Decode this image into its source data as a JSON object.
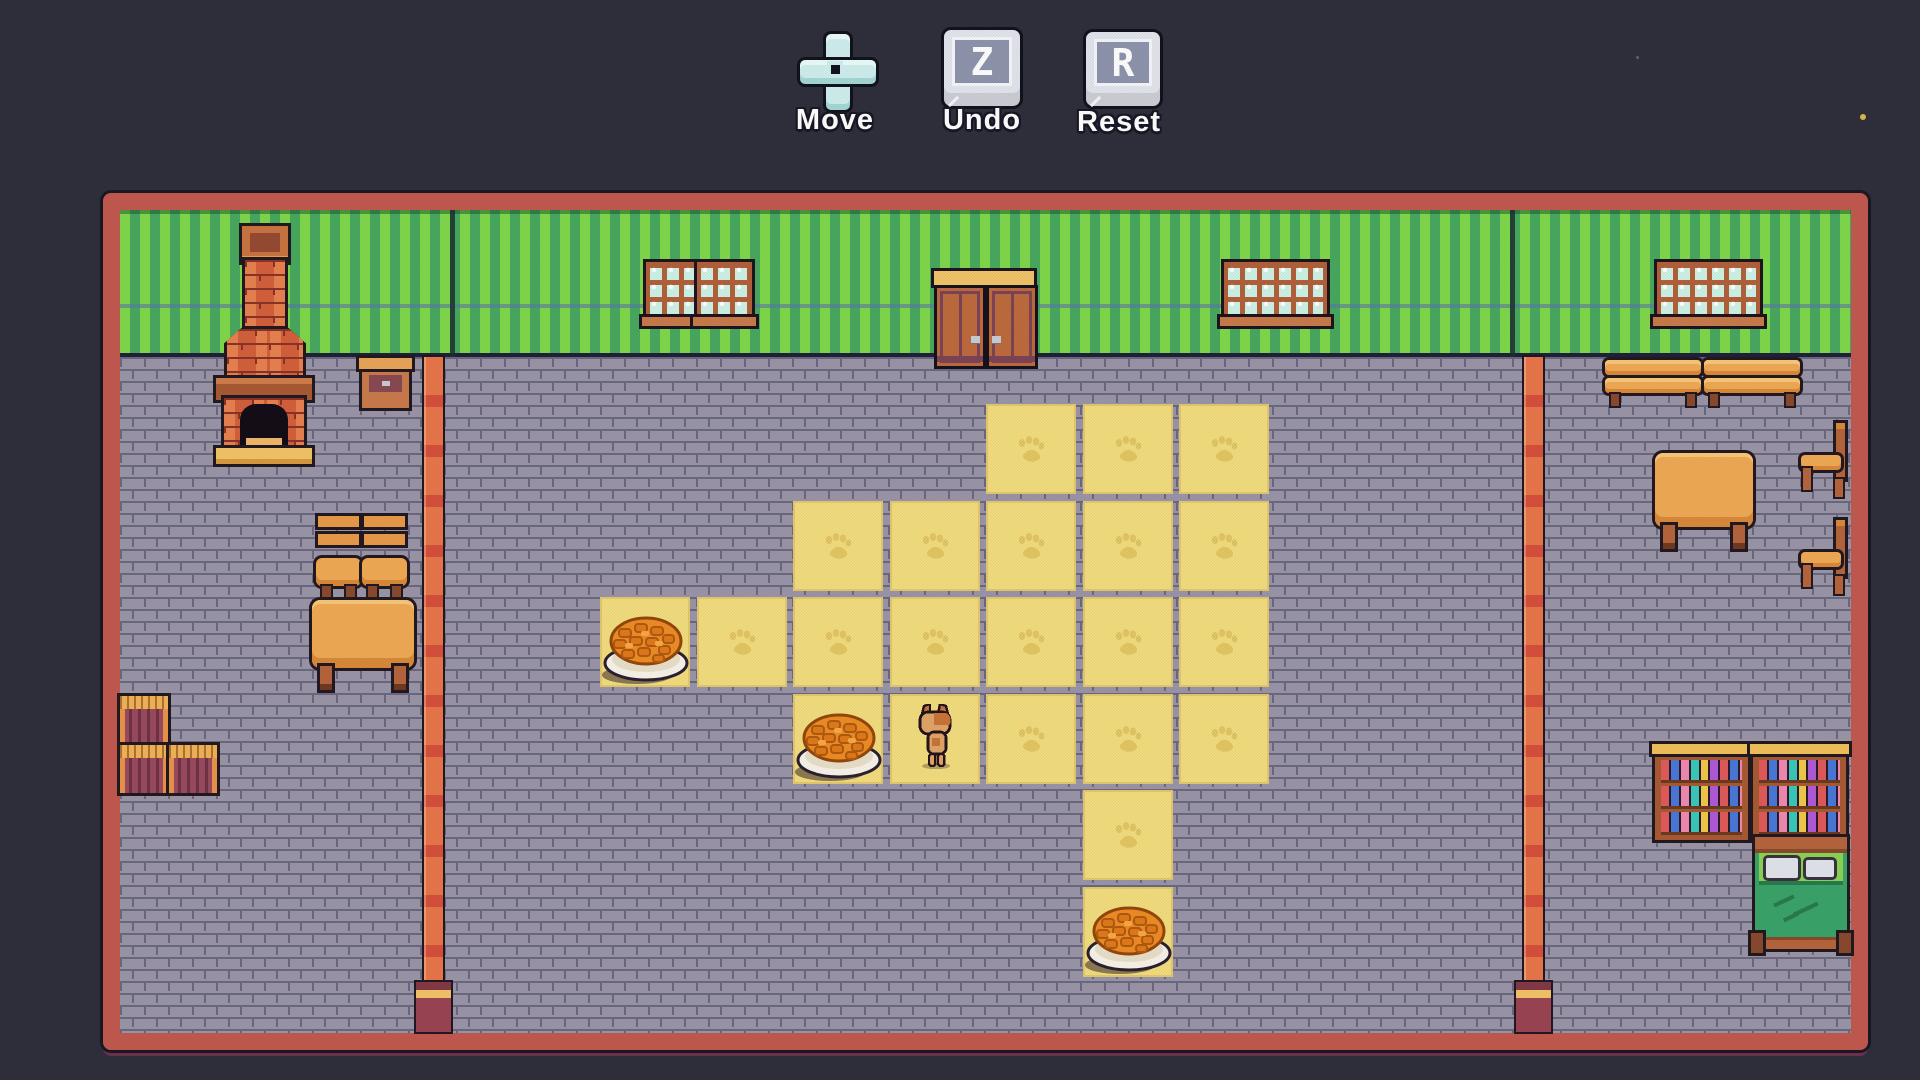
{
  "ui": {
    "controls": [
      {
        "id": "move",
        "label": "Move",
        "type": "dpad"
      },
      {
        "id": "undo",
        "label": "Undo",
        "type": "key",
        "key": "Z"
      },
      {
        "id": "reset",
        "label": "Reset",
        "type": "key",
        "key": "R"
      }
    ]
  },
  "game_state": {
    "grid": {
      "origin_x": 600,
      "origin_y": 404,
      "pitch": 96.5,
      "tile_size": 90,
      "cols": 7,
      "rows": 6
    },
    "tiles": [
      {
        "col": 4,
        "row": 0,
        "paw": true
      },
      {
        "col": 5,
        "row": 0,
        "paw": true
      },
      {
        "col": 6,
        "row": 0,
        "paw": true
      },
      {
        "col": 2,
        "row": 1,
        "paw": true
      },
      {
        "col": 3,
        "row": 1,
        "paw": true
      },
      {
        "col": 4,
        "row": 1,
        "paw": true
      },
      {
        "col": 5,
        "row": 1,
        "paw": true
      },
      {
        "col": 6,
        "row": 1,
        "paw": true
      },
      {
        "col": 0,
        "row": 2,
        "paw": false
      },
      {
        "col": 1,
        "row": 2,
        "paw": true
      },
      {
        "col": 2,
        "row": 2,
        "paw": true
      },
      {
        "col": 3,
        "row": 2,
        "paw": true
      },
      {
        "col": 4,
        "row": 2,
        "paw": true
      },
      {
        "col": 5,
        "row": 2,
        "paw": true
      },
      {
        "col": 6,
        "row": 2,
        "paw": true
      },
      {
        "col": 2,
        "row": 3,
        "paw": false
      },
      {
        "col": 3,
        "row": 3,
        "paw": false
      },
      {
        "col": 4,
        "row": 3,
        "paw": true
      },
      {
        "col": 5,
        "row": 3,
        "paw": true
      },
      {
        "col": 6,
        "row": 3,
        "paw": true
      },
      {
        "col": 5,
        "row": 4,
        "paw": true
      },
      {
        "col": 5,
        "row": 5,
        "paw": false
      }
    ],
    "bowls": [
      {
        "col": 0,
        "row": 2
      },
      {
        "col": 2,
        "row": 3
      },
      {
        "col": 5,
        "row": 5
      }
    ],
    "cat": {
      "col": 3,
      "row": 3
    }
  },
  "palette": {
    "bg": "#2f2e3b",
    "outline": "#191924",
    "border": "#c2594f",
    "border_dark": "#6e3150",
    "wall_light": "#7fd84b",
    "wall_dark": "#48a85e",
    "wall_trim": "#5878a8",
    "floor": "#9a96a8",
    "floor_mortar": "#6b6880",
    "tile": "#f2dd7e",
    "paw": "#d8b44e",
    "pillar": "#e8764a",
    "pillar_red": "#d5503c",
    "pillar_base": "#9a4452",
    "wood_light": "#f0a955",
    "wood_mid": "#c97a4a",
    "wood_dark": "#8a4a2e",
    "wood_frame": "#b5643c",
    "panel_dark": "#7c4456",
    "brick": "#d4603c",
    "brick_light": "#e8814f",
    "brick_mortar": "#8a3428",
    "hearth": "#f2c468",
    "door": "#bd6a3d",
    "lintel": "#f0c469",
    "pane": "#cdf2e6",
    "bed_green": "#3aa368",
    "bed_green_light": "#8cd352",
    "pillow": "#e2e4ec",
    "kibble": "#ee8c25",
    "plate": "#f8f3e8",
    "cat_tan": "#e0a468",
    "cat_orange": "#c97439",
    "dpad": "#cfeeed",
    "keycap": "#e2e5ec",
    "keyface": "#8e94ac",
    "label": "#ffffff",
    "label_outline": "#181826"
  }
}
